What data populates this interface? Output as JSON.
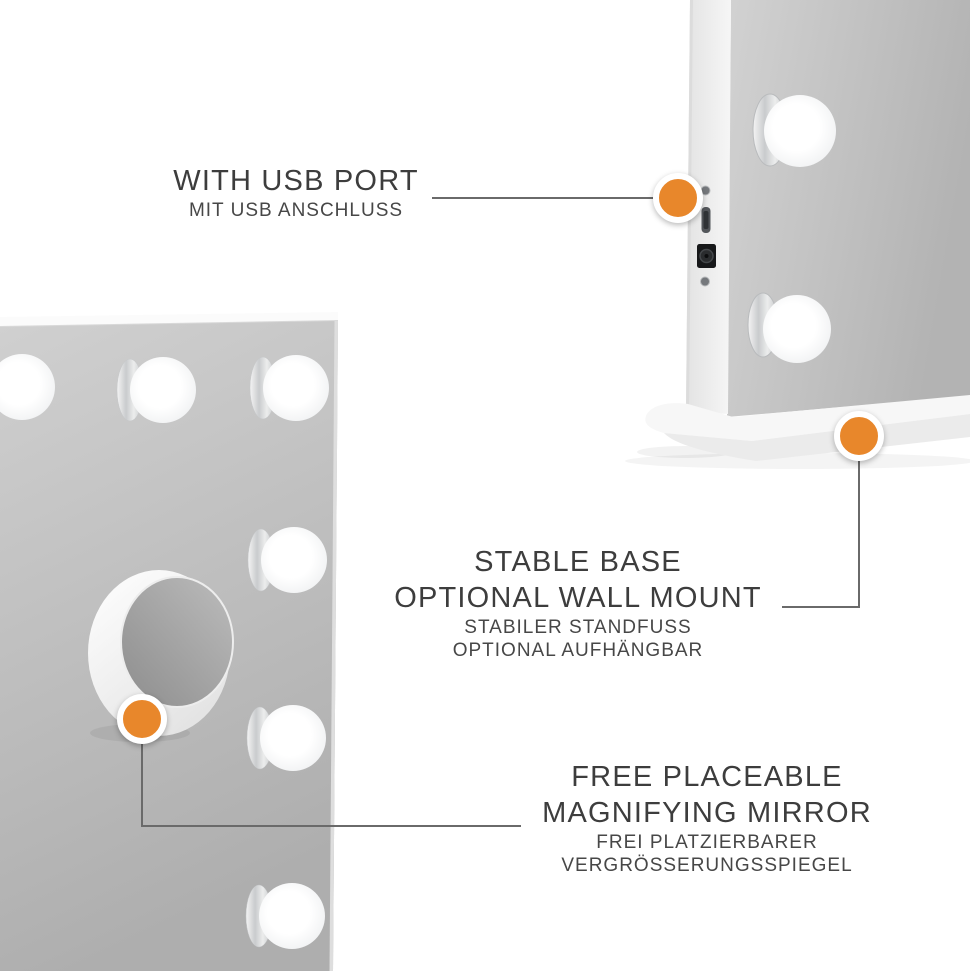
{
  "page": {
    "background": "#ffffff"
  },
  "colors": {
    "accent_orange": "#E8872B",
    "connector_gray": "#6a6a6a",
    "title_text": "#3d3d3d",
    "subtitle_text": "#474747"
  },
  "annotations": {
    "usb_port": {
      "title": "WITH USB PORT",
      "subtitle": "MIT USB ANSCHLUSS",
      "marker": "usb-port-marker"
    },
    "stable_base": {
      "title_line1": "STABLE BASE",
      "title_line2": "OPTIONAL WALL MOUNT",
      "subtitle_line1": "STABILER STANDFUSS",
      "subtitle_line2": "OPTIONAL AUFHÄNGBAR",
      "marker": "stable-base-marker"
    },
    "magnifying_mirror": {
      "title_line1": "FREE PLACEABLE",
      "title_line2": "MAGNIFYING MIRROR",
      "subtitle_line1": "FREI PLATZIERBARER",
      "subtitle_line2": "VERGRÖSSERUNGSSPIEGEL",
      "marker": "magnifying-mirror-marker"
    }
  },
  "product": {
    "icons": [
      "led-bulb-icon",
      "usb-port-icon",
      "dc-jack-icon",
      "screw-icon",
      "magnifying-mirror-icon",
      "stand-base-icon"
    ]
  }
}
